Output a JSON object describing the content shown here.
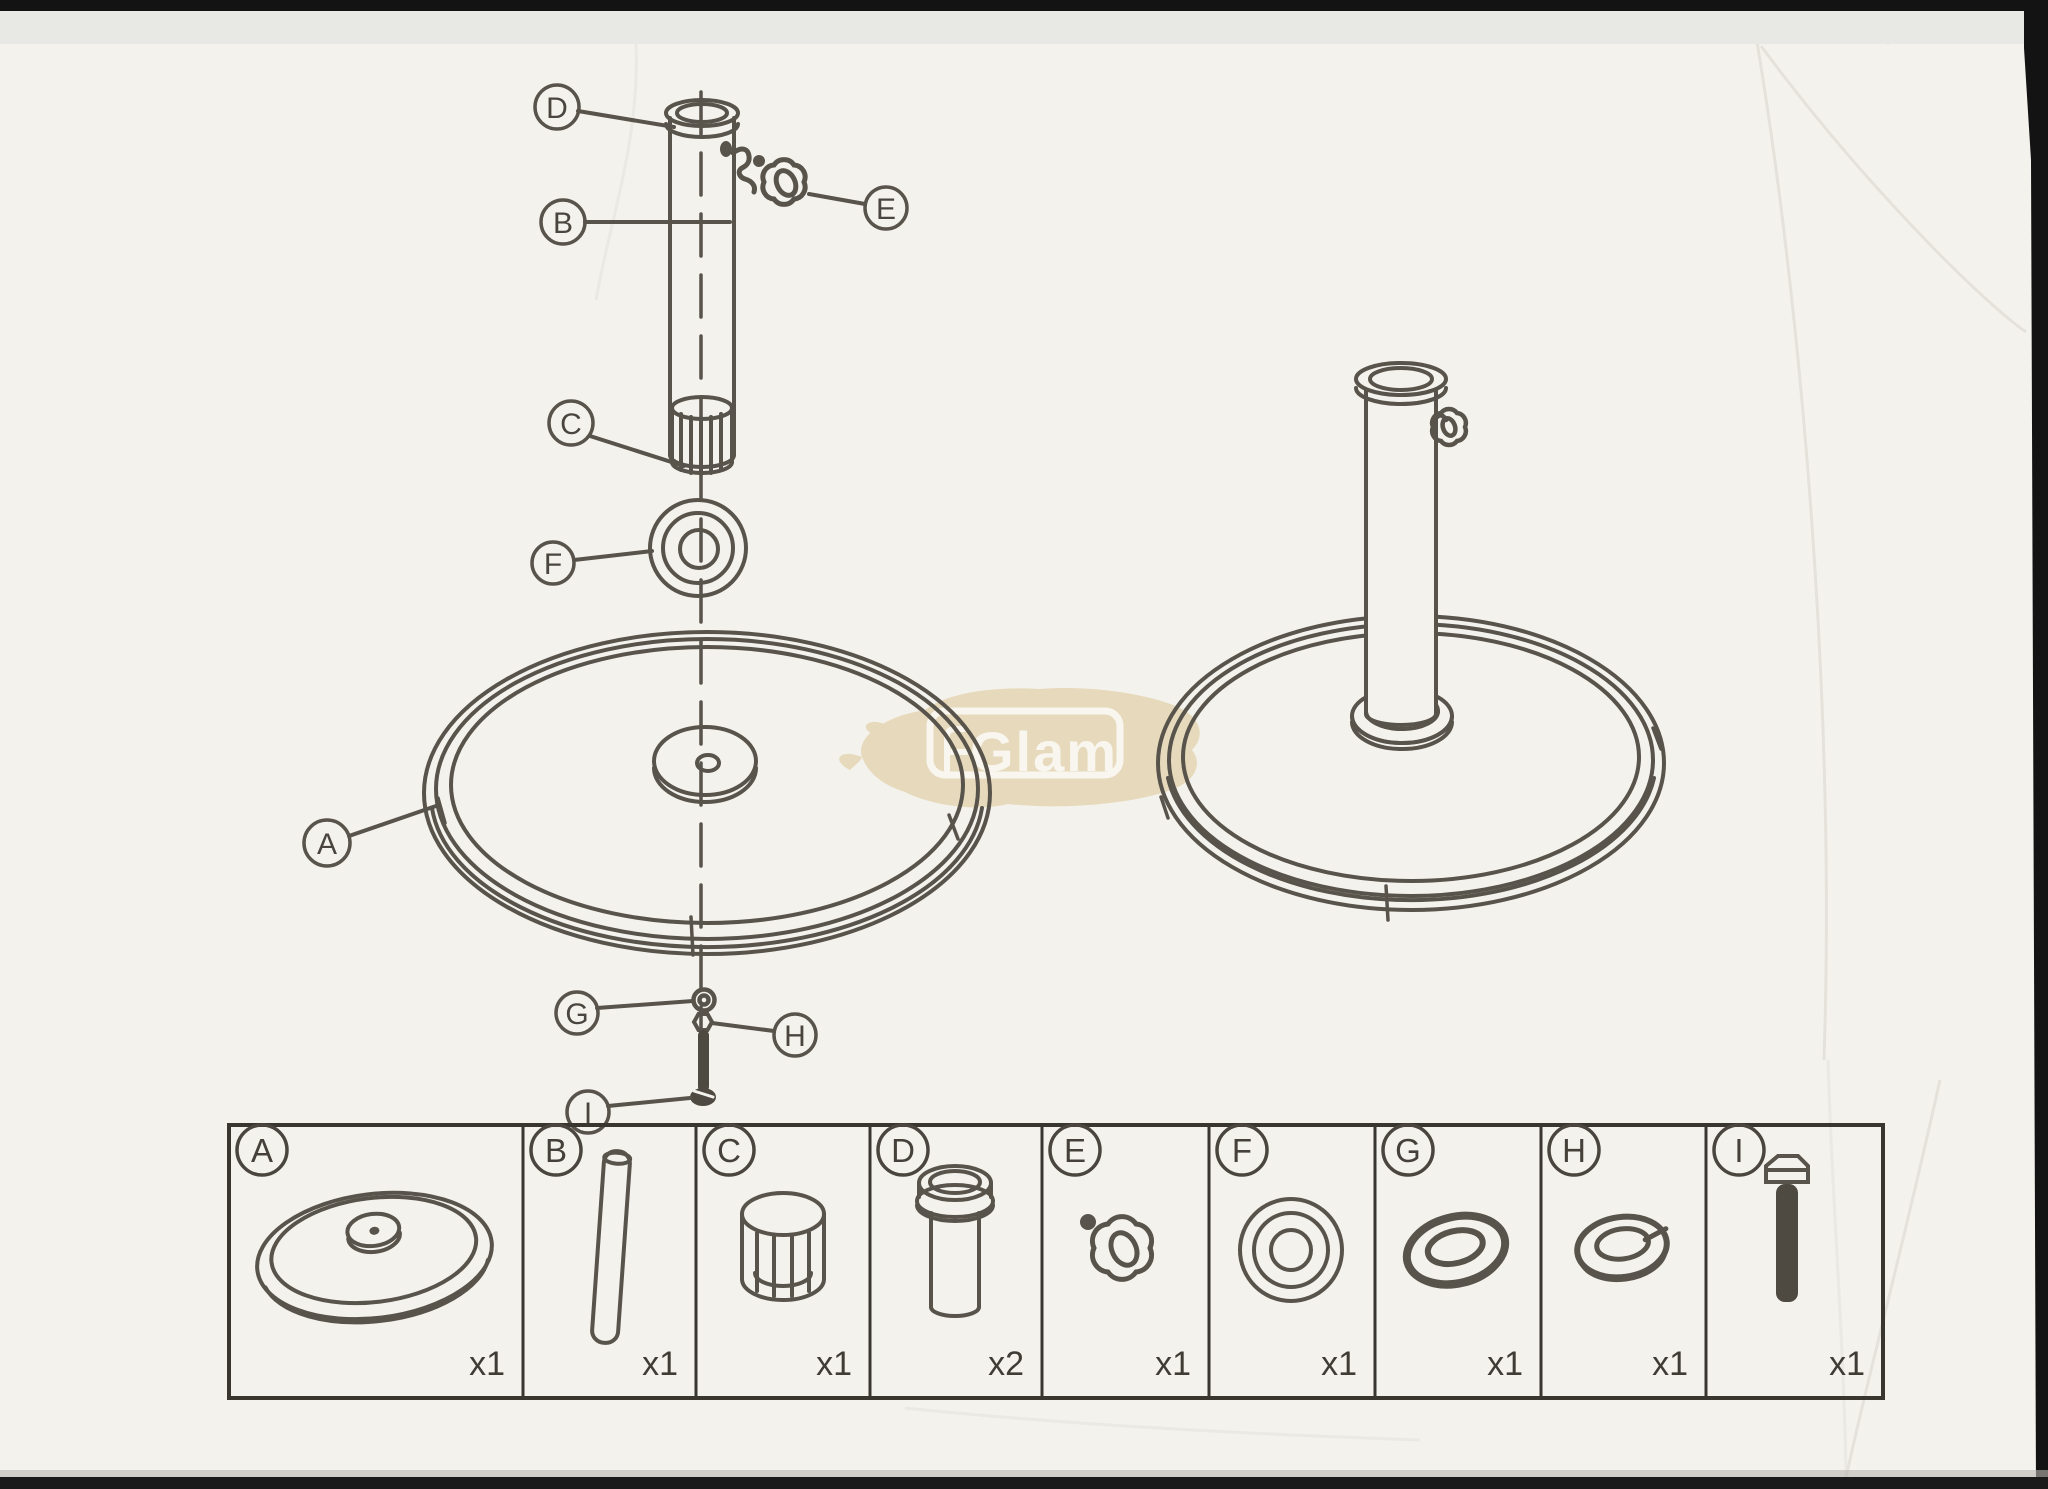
{
  "meta": {
    "description": "Scanned exploded-view assembly instruction sheet for a weighted umbrella base",
    "colors": {
      "paper": "#f3f2ec",
      "ink": "#58534b",
      "table_border": "#39362f",
      "scan_edge": "#131313",
      "watermark_tan": "#e7dabc",
      "watermark_white": "#f8f6ef"
    }
  },
  "watermark": {
    "text": "Glam"
  },
  "callouts": {
    "exploded": [
      "D",
      "B",
      "E",
      "C",
      "F",
      "A",
      "G",
      "H",
      "I"
    ]
  },
  "parts_table": {
    "cells": [
      {
        "letter": "A",
        "qty": "x1",
        "icon": "base-disc-icon"
      },
      {
        "letter": "B",
        "qty": "x1",
        "icon": "pole-tube-icon"
      },
      {
        "letter": "C",
        "qty": "x1",
        "icon": "slotted-insert-icon"
      },
      {
        "letter": "D",
        "qty": "x2",
        "icon": "flanged-sleeve-icon"
      },
      {
        "letter": "E",
        "qty": "x1",
        "icon": "star-knob-icon"
      },
      {
        "letter": "F",
        "qty": "x1",
        "icon": "washer-ring-icon"
      },
      {
        "letter": "G",
        "qty": "x1",
        "icon": "flat-washer-icon"
      },
      {
        "letter": "H",
        "qty": "x1",
        "icon": "spring-washer-icon"
      },
      {
        "letter": "I",
        "qty": "x1",
        "icon": "hex-bolt-icon"
      }
    ]
  }
}
